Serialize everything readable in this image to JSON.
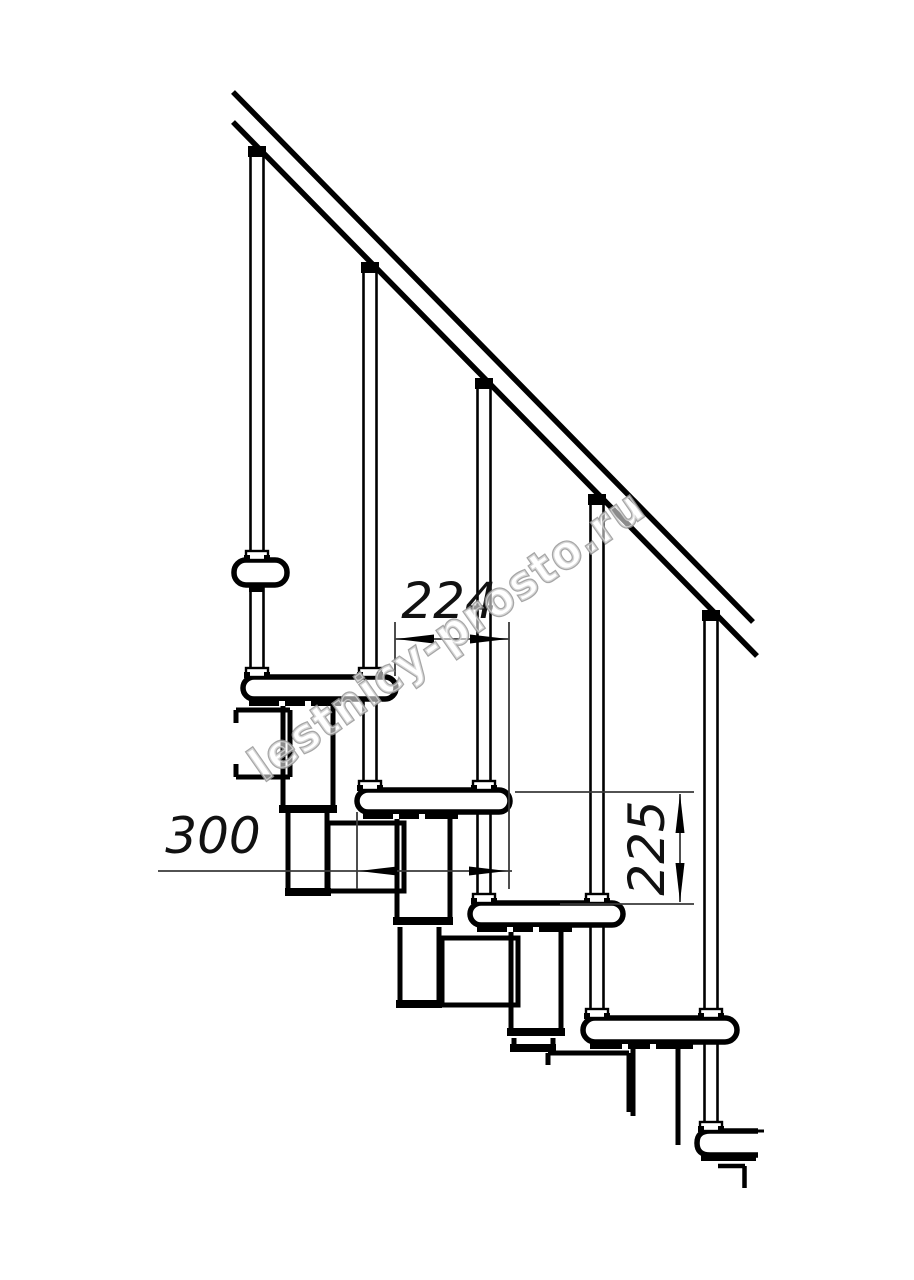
{
  "drawing": {
    "kind": "modular-staircase-side-view"
  },
  "dimensions": {
    "run": "224",
    "tread_length": "300",
    "rise": "225"
  },
  "watermark": {
    "text": "lestnicy-prosto.ru",
    "color": "#969696"
  },
  "colors": {
    "line": "#000000",
    "background": "#ffffff",
    "dimension_line": "#444444"
  }
}
